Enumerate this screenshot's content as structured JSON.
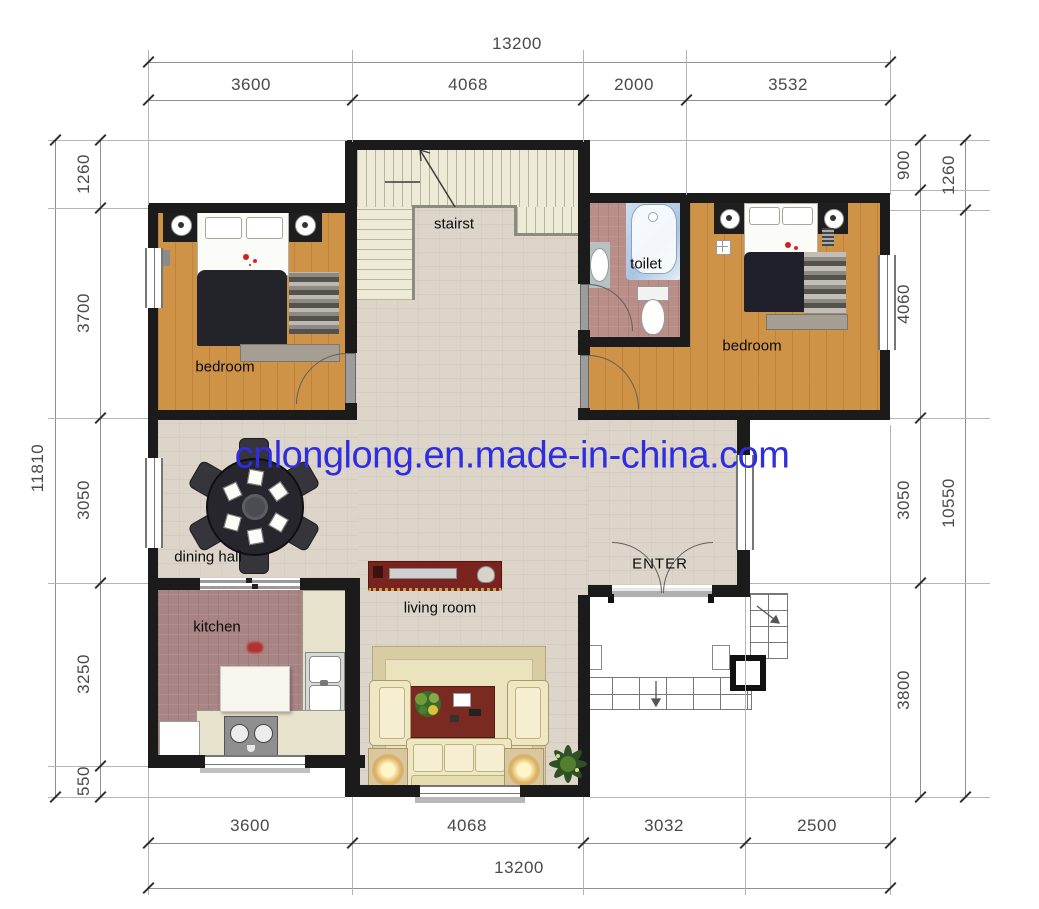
{
  "watermark": {
    "text": "cnlonglong.en.made-in-china.com",
    "color": "#2e2ee0"
  },
  "labels": {
    "bedroom_left": "bedroom",
    "bedroom_right": "bedroom",
    "stairs": "stairst",
    "toilet": "toilet",
    "dining": "dining hall",
    "kitchen": "kitchen",
    "living": "living room",
    "enter": "ENTER"
  },
  "dims": {
    "top": {
      "total": "13200",
      "segments": [
        "3600",
        "4068",
        "2000",
        "3532"
      ]
    },
    "bottom": {
      "total": "13200",
      "segments": [
        "3600",
        "4068",
        "3032",
        "2500"
      ]
    },
    "left": {
      "total": "11810",
      "segments": [
        "1260",
        "3700",
        "3050",
        "3250",
        "550"
      ]
    },
    "right": {
      "inner": [
        "900",
        "4060",
        "3050",
        "3800"
      ],
      "outer": [
        "1260",
        "10550"
      ]
    }
  },
  "colors": {
    "wall": "#1b1b1b",
    "wood_floor": "#cf9348",
    "hall_floor": "#ddd5ca",
    "wet_floor": "#b08382",
    "stairs_floor": "#edebd8",
    "watermark_blue": "#2e2ee0",
    "tv_cabinet_red": "#7a2420",
    "dining_table_dark": "#27272e"
  }
}
